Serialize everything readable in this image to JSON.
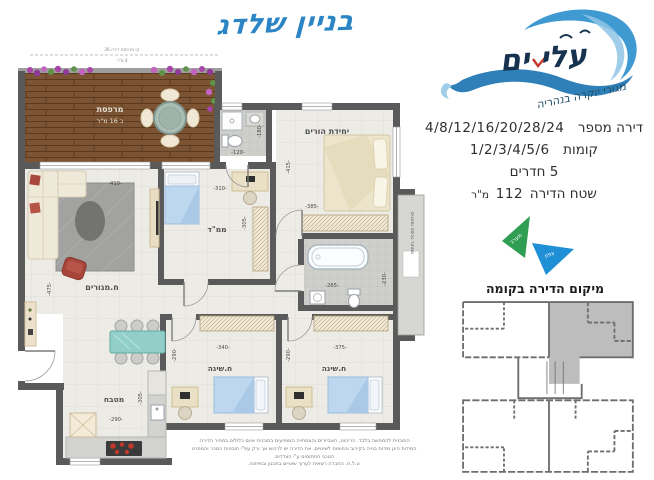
{
  "title": "בניין שלדג",
  "logo": {
    "brand": "עלי ים",
    "tagline": "מגורי יוקרה בנהריה"
  },
  "details": {
    "apartment_label": "דירה מספר",
    "apartment_numbers": "4/8/12/16/20/28/24",
    "floors_label": "קומות",
    "floors_numbers": "1/2/3/4/5/6",
    "rooms_line": "5 חדרים",
    "area_label": "שטח הדירה",
    "area_value": "112",
    "area_unit": "מ\"ר"
  },
  "compass": {
    "west": "מערב",
    "north": "צפון"
  },
  "keyplan": {
    "title": "מיקום הדירה בקומה"
  },
  "plan": {
    "rooms": {
      "balcony": "מרפסת",
      "balcony_area": "כ 16 מ\"ר",
      "living": "ח.מגורים",
      "mamad": "ממ\"ד",
      "master": "יחידת הורים",
      "bedroom1": "ח.שינה",
      "bedroom2": "ח.שינה",
      "kitchen": "מטבח",
      "laundry": "מסתור כביסה ומזגנים"
    },
    "note": {
      "line1": "קו מרפסת דירה 26",
      "line2": "4 מ\"ר"
    },
    "dims": {
      "living_w": "-410-",
      "living_h": "-475-",
      "mamad_w": "-310-",
      "mamad_h": "-305-",
      "bath_top_w": "-120-",
      "bath_top_h": "-180-",
      "master_w": "-385-",
      "master_h": "-415-",
      "bath_w": "-265-",
      "bath_h": "-230-",
      "bedroom1_w": "-340-",
      "bedroom1_h": "-290-",
      "bedroom2_w": "-375-",
      "bedroom2_h": "-290-",
      "kitchen_w": "-290-",
      "kitchen_h": "-305-"
    }
  },
  "colors": {
    "wall": "#5a5a5a",
    "accent_blue": "#2b85c4",
    "logo_navy": "#16324f",
    "compass_west": "#2f9e52",
    "compass_north": "#1f8fd6",
    "keyplan_highlight": "#bdbdbd"
  },
  "disclaimer": {
    "line1": "התוכנית להמחשה בלבד. הריהוט, האביזרים והצמחייה המופיעים בתוכנית אינם כלולים במחיר הדירה.",
    "line2": "המידות הינן מידות בנייה בקירוב וכפופות לשינויים. את הדירה יש לרכוש אך ורק עפ\"י תוכניות המכר והמפרט הטכני החתומים ע\"י הצדדים.",
    "line3": "ט.ל.ח. החברה רשאית לערוך שינויים בתכנון ובפיתוח."
  }
}
